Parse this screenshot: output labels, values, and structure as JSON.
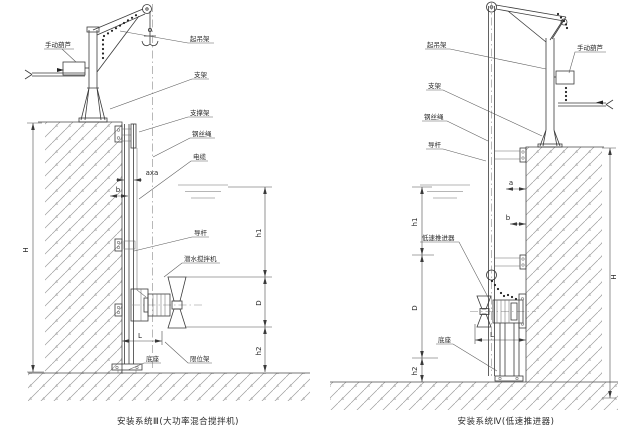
{
  "left": {
    "caption": "安装系统Ⅲ(大功率混合搅拌机)",
    "labels": {
      "manual_hoist": "手动葫芦",
      "lifting_frame": "起吊架",
      "bracket": "支架",
      "support_frame": "支撑架",
      "wire_rope": "钢丝绳",
      "cable": "电缆",
      "guide_rod": "导杆",
      "mixer": "潜水搅拌机",
      "base": "底座",
      "limit_frame": "限位架"
    },
    "dims": {
      "H": "H",
      "h1": "h1",
      "h2": "h2",
      "D": "D",
      "L": "L",
      "b": "b",
      "axa": "axa"
    }
  },
  "right": {
    "caption": "安装系统Ⅳ(低速推进器)",
    "labels": {
      "lifting_frame": "起吊架",
      "manual_hoist": "手动葫芦",
      "bracket": "支架",
      "wire_rope": "钢丝绳",
      "guide_rod": "导杆",
      "thruster": "低速推进器",
      "base": "底座"
    },
    "dims": {
      "H": "H",
      "h1": "h1",
      "h2": "h2",
      "D": "D",
      "L": "L",
      "a": "a",
      "b": "b"
    }
  }
}
